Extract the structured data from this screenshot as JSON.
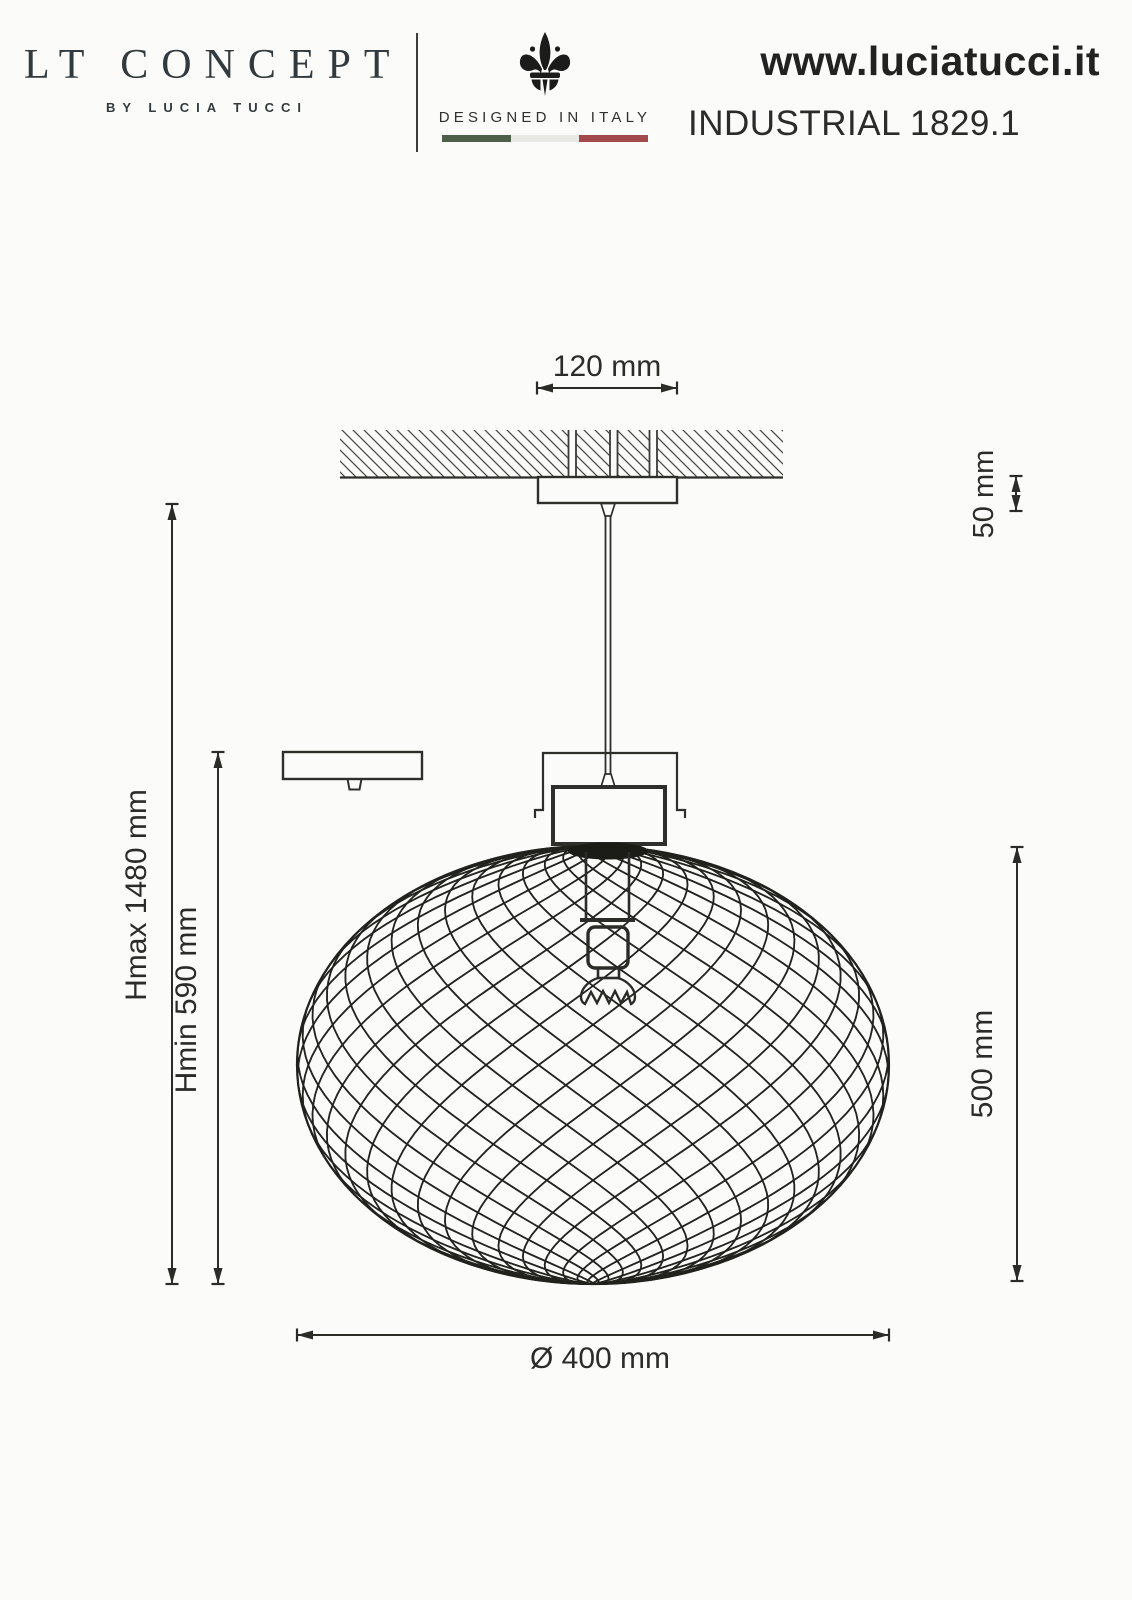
{
  "header": {
    "brand": {
      "logo": "LT CONCEPT",
      "byline": "BY LUCIA TUCCI"
    },
    "made_in": {
      "label": "DESIGNED IN ITALY",
      "emblem": "fleur-de-lis",
      "flag_colors": {
        "green": "#4d5e49",
        "white": "#e8e8e4",
        "red": "#a1494d"
      }
    },
    "website": "www.luciatucci.it",
    "product": "INDUSTRIAL 1829.1"
  },
  "drawing": {
    "line_color": "#2e2e2a",
    "dimensions": {
      "canopy_width": "120 mm",
      "canopy_height": "50 mm",
      "height_max": "Hmax 1480 mm",
      "height_min": "Hmin 590 mm",
      "shade_height": "500 mm",
      "shade_diameter": "Ø 400 mm"
    }
  }
}
